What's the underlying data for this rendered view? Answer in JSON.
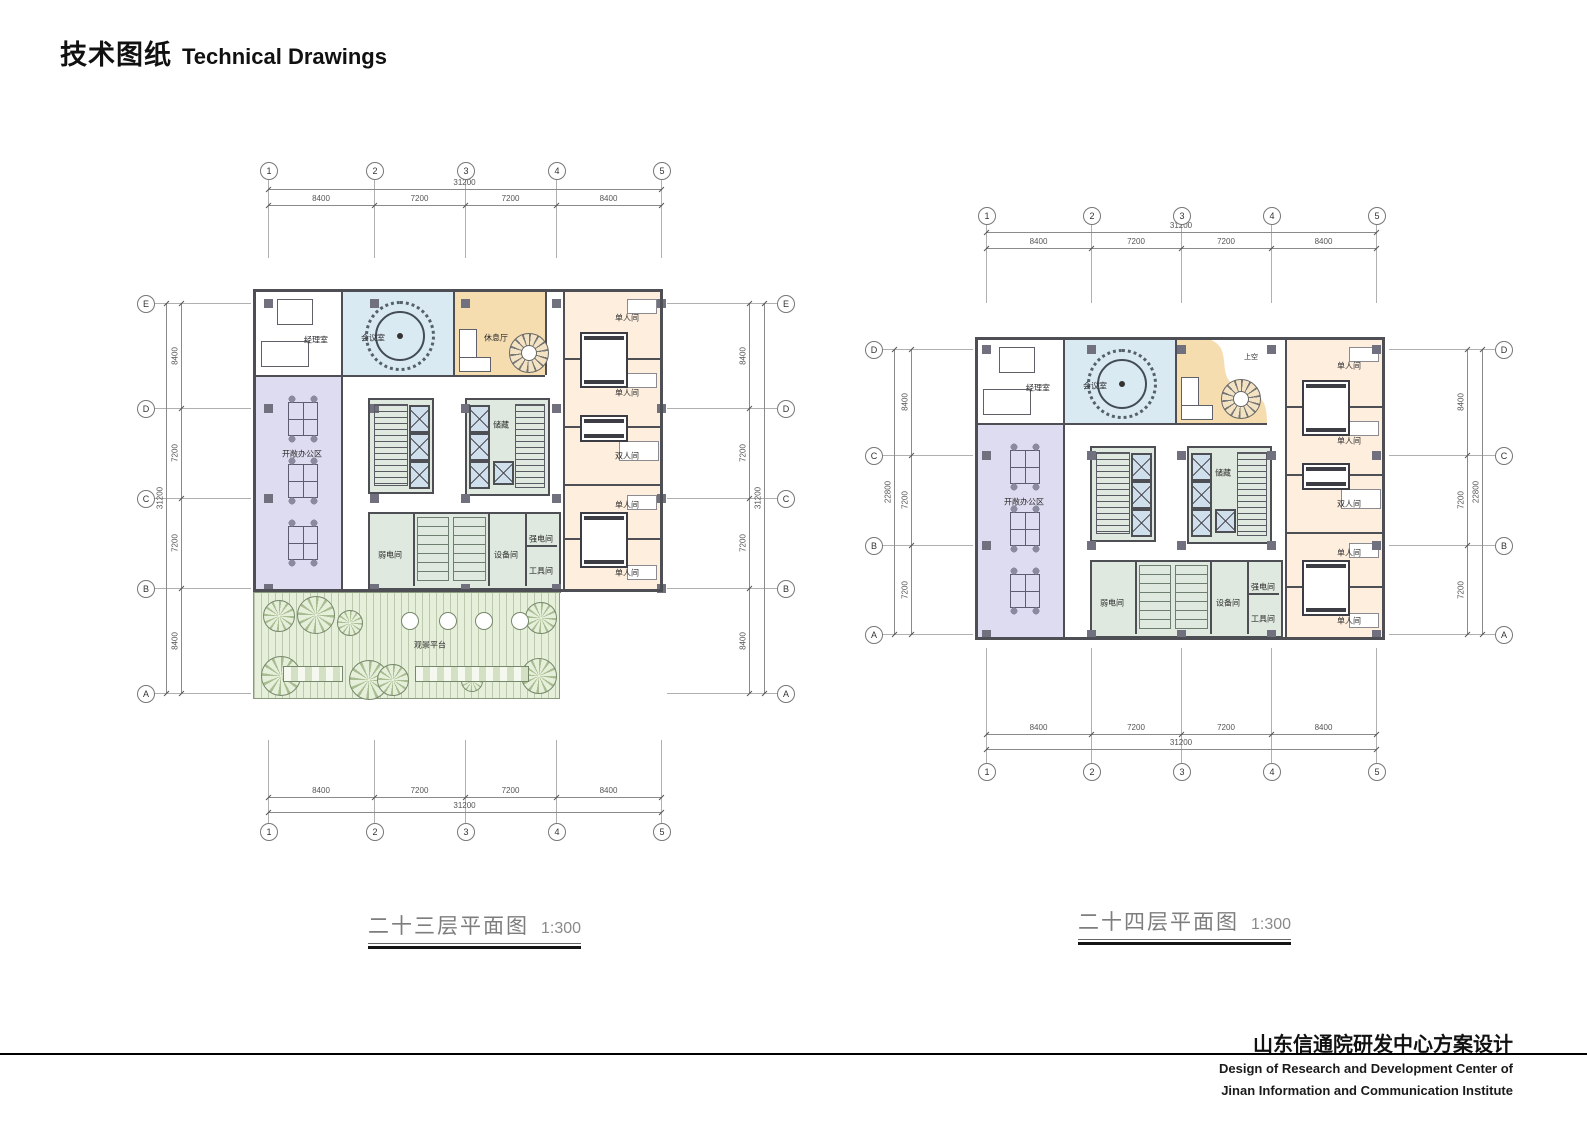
{
  "page": {
    "title_zh": "技术图纸",
    "title_en": "Technical Drawings"
  },
  "labels": {
    "manager_office": "经理室",
    "meeting_room": "会议室",
    "lounge": "休息厅",
    "open_office": "开敞办公区",
    "storage": "储藏",
    "weak_electric_room": "弱电间",
    "equipment_room": "设备间",
    "strong_electric_room": "强电间",
    "tool_room": "工具间",
    "single_room": "单人间",
    "double_room": "双人间",
    "viewing_deck": "观景平台",
    "void_above": "上空"
  },
  "plans": {
    "f23": {
      "caption": "二十三层平面图",
      "scale": "1:300",
      "grid": {
        "cols": [
          "1",
          "2",
          "3",
          "4",
          "5"
        ],
        "col_dims": [
          "8400",
          "7200",
          "7200",
          "8400"
        ],
        "col_total": "31200",
        "rows": [
          "E",
          "D",
          "C",
          "B",
          "A"
        ],
        "row_dims": [
          "8400",
          "7200",
          "7200",
          "8400"
        ],
        "row_total": "31200"
      }
    },
    "f24": {
      "caption": "二十四层平面图",
      "scale": "1:300",
      "grid": {
        "cols": [
          "1",
          "2",
          "3",
          "4",
          "5"
        ],
        "col_dims": [
          "8400",
          "7200",
          "7200",
          "8400"
        ],
        "col_total": "31200",
        "rows": [
          "D",
          "C",
          "B",
          "A"
        ],
        "row_dims": [
          "8400",
          "7200",
          "7200"
        ],
        "row_total": "22800"
      }
    }
  },
  "footer": {
    "project_zh": "山东信通院研发中心方案设计",
    "project_en_line1": "Design of Research and Development Center of",
    "project_en_line2": "Jinan Information and Communication Institute"
  },
  "colors": {
    "wall": "#4e4e55",
    "meeting_blue": "#d9eaf3",
    "lounge_orange": "#f6ddb0",
    "office_lavender": "#dedcf0",
    "guest_peach": "#fdeede",
    "service_green": "#dfe9df",
    "terrace_green": "#e6efda",
    "column_gray": "#70707e",
    "elevator_blue": "#cfe0ec"
  }
}
